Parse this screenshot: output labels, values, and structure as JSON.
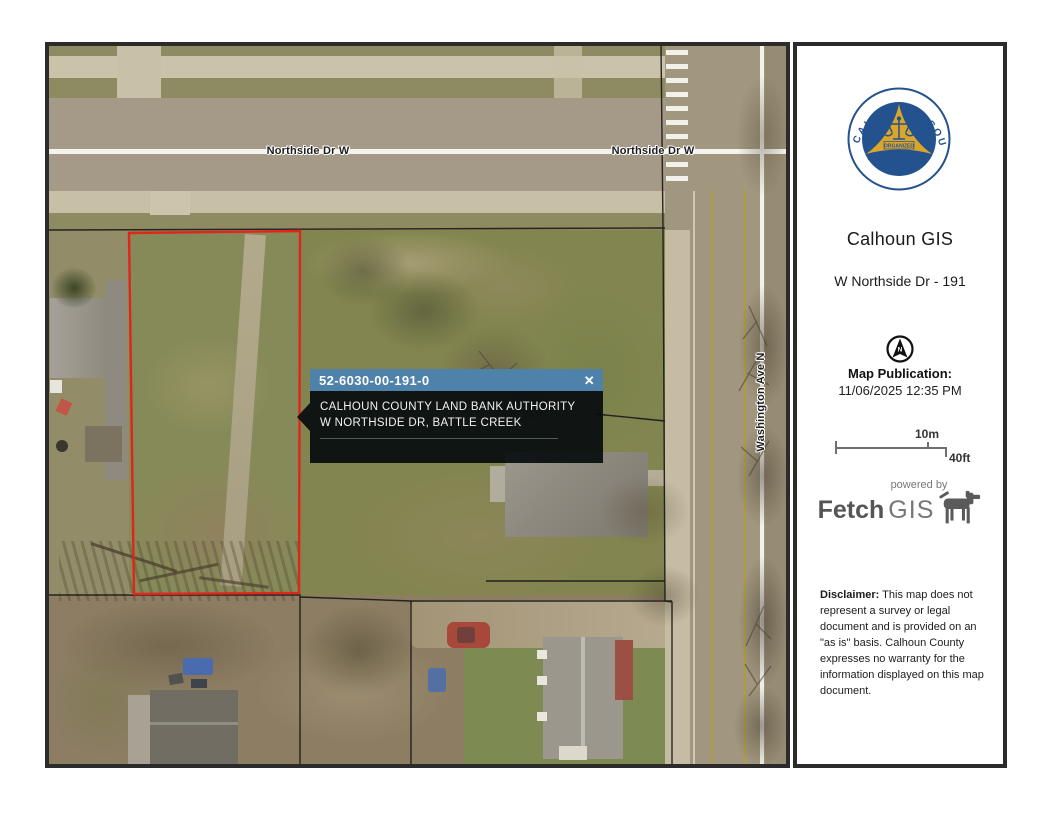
{
  "map": {
    "streets": {
      "northside_w_left": "Northside Dr W",
      "northside_w_right": "Northside Dr W",
      "washington_ave": "Washington Ave N"
    },
    "popup": {
      "parcel_id": "52-6030-00-191-0",
      "line1": "CALHOUN COUNTY LAND BANK AUTHORITY",
      "line2": "W NORTHSIDE DR, BATTLE CREEK",
      "close_icon": "✕",
      "header_color": "#4e82aa"
    },
    "parcel_outline_color": "#e1251b"
  },
  "sidebar": {
    "seal": {
      "arc_left": "CALHOUN",
      "arc_right": "COUNTY",
      "arc_bottom": "MICHIGAN",
      "banner": "ORGANIZED",
      "year": "1833",
      "blue": "#24528f",
      "gold": "#d9a62b"
    },
    "title": "Calhoun GIS",
    "subtitle": "W Northside Dr - 191",
    "north_label": "N",
    "publication_label": "Map Publication:",
    "publication_datetime": "11/06/2025 12:35 PM",
    "scale": {
      "metric_label": "10m",
      "imperial_label": "40ft"
    },
    "fetchgis": {
      "powered_by": "powered by",
      "brand_bold": "Fetch",
      "brand_rest": "GIS"
    },
    "disclaimer_label": "Disclaimer:",
    "disclaimer_text": " This map does not represent a survey or legal document and is provided on an \"as is\" basis. Calhoun County expresses no warranty for the information displayed on this map document."
  }
}
